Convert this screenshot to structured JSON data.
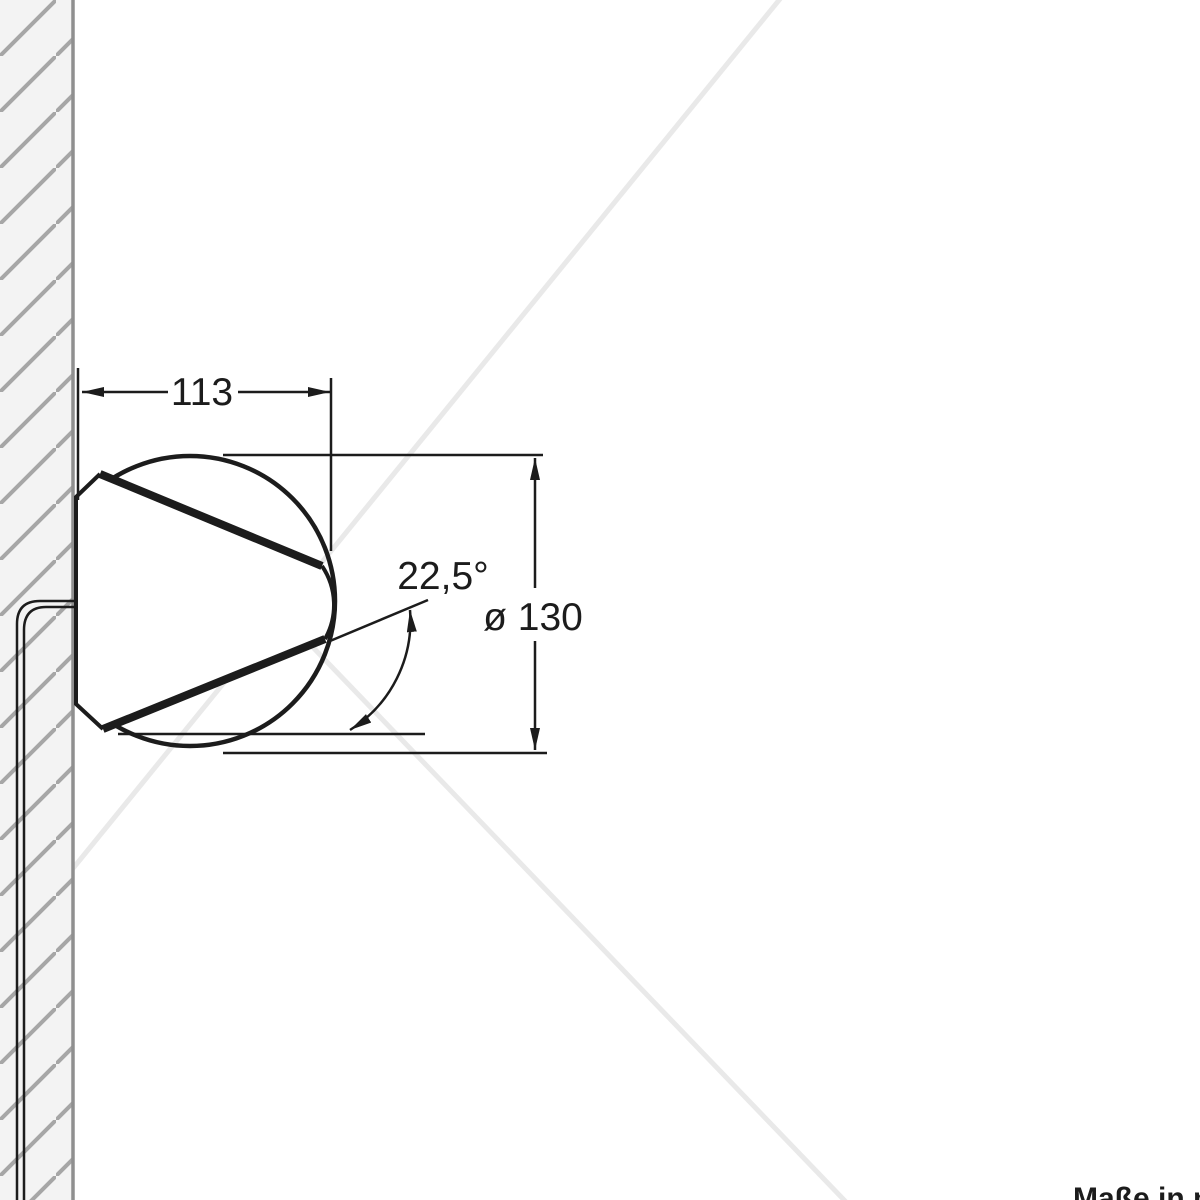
{
  "drawing": {
    "type": "technical-dimension-drawing",
    "subject": "wall-mounted round speaker/fixture, side view",
    "width_label": "113",
    "angle_label": "22,5°",
    "diameter_label": "ø 130",
    "units_note": "Maße in mm",
    "colors": {
      "line": "#1c1c1c",
      "wall_fill": "#f3f3f3",
      "hatch": "#a6a6a6",
      "wall_edge": "#8f8f8f",
      "watermark": "#e9e9e9",
      "background": "#ffffff"
    }
  }
}
